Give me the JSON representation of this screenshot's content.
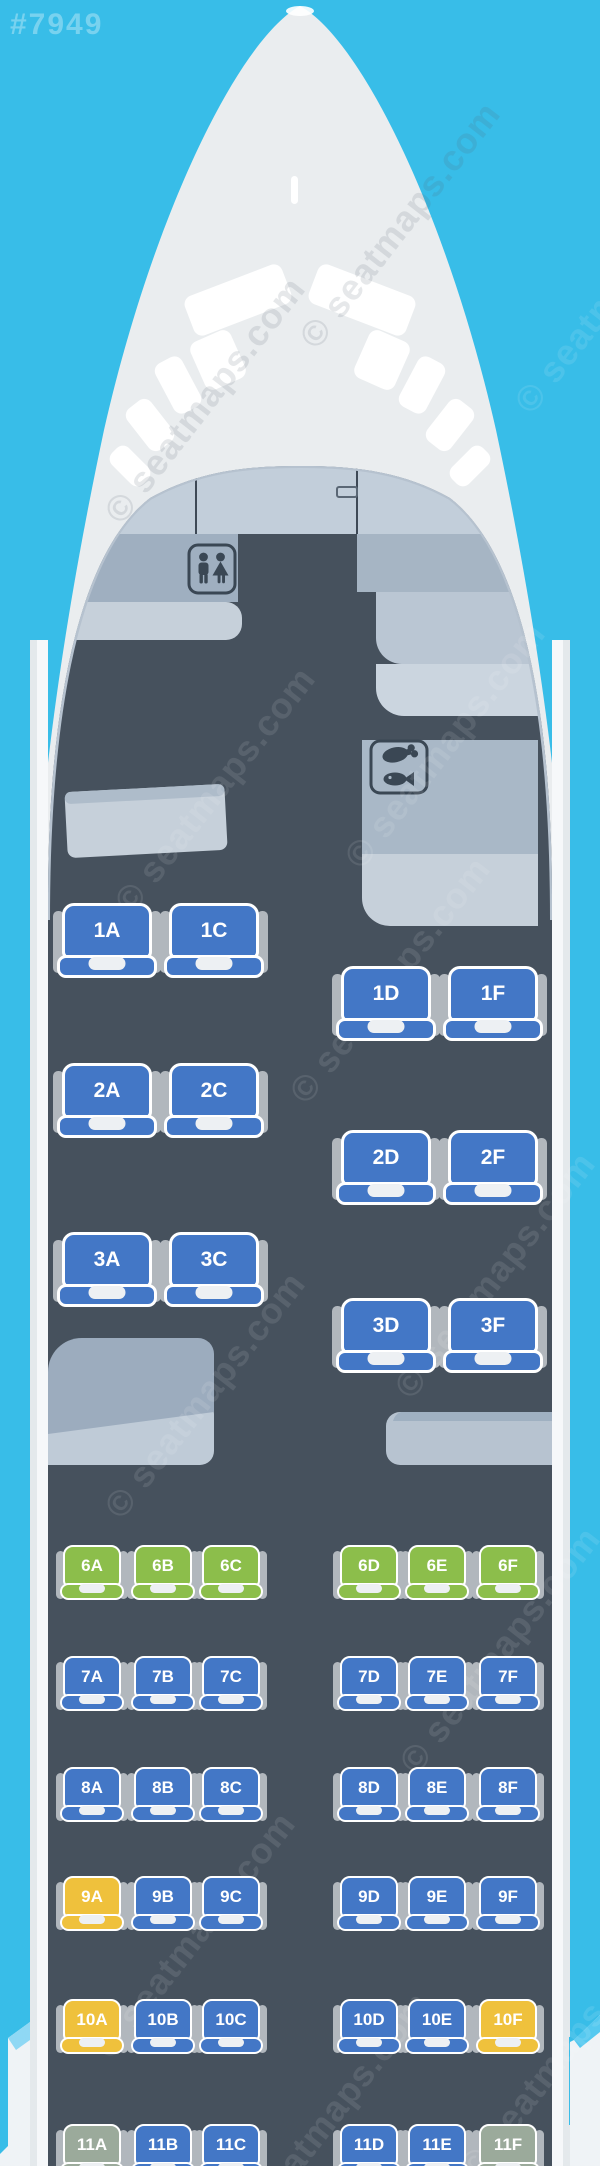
{
  "map_id": "#7949",
  "watermark_text": "© seatmaps.com",
  "colors": {
    "background": "#38BDE8",
    "fuselage": "#EAEDEF",
    "cabin_floor": "#46515D",
    "seat_blue": "#4377C6",
    "seat_green": "#8CBE4B",
    "seat_yellow": "#EFC13C",
    "seat_sage": "#9BAA9B"
  },
  "icons": {
    "front_monument": "lavatory",
    "right_galley": "meal-service"
  },
  "cabin": {
    "rows": [
      {
        "row": "1",
        "section": "business",
        "seats": [
          {
            "id": "1A",
            "color": "seat_blue"
          },
          {
            "id": "1C",
            "color": "seat_blue"
          },
          {
            "id": "1D",
            "color": "seat_blue"
          },
          {
            "id": "1F",
            "color": "seat_blue"
          }
        ]
      },
      {
        "row": "2",
        "section": "business",
        "seats": [
          {
            "id": "2A",
            "color": "seat_blue"
          },
          {
            "id": "2C",
            "color": "seat_blue"
          },
          {
            "id": "2D",
            "color": "seat_blue"
          },
          {
            "id": "2F",
            "color": "seat_blue"
          }
        ]
      },
      {
        "row": "3",
        "section": "business",
        "seats": [
          {
            "id": "3A",
            "color": "seat_blue"
          },
          {
            "id": "3C",
            "color": "seat_blue"
          },
          {
            "id": "3D",
            "color": "seat_blue"
          },
          {
            "id": "3F",
            "color": "seat_blue"
          }
        ]
      },
      {
        "row": "6",
        "section": "economy",
        "seats": [
          {
            "id": "6A",
            "color": "seat_green"
          },
          {
            "id": "6B",
            "color": "seat_green"
          },
          {
            "id": "6C",
            "color": "seat_green"
          },
          {
            "id": "6D",
            "color": "seat_green"
          },
          {
            "id": "6E",
            "color": "seat_green"
          },
          {
            "id": "6F",
            "color": "seat_green"
          }
        ]
      },
      {
        "row": "7",
        "section": "economy",
        "seats": [
          {
            "id": "7A",
            "color": "seat_blue"
          },
          {
            "id": "7B",
            "color": "seat_blue"
          },
          {
            "id": "7C",
            "color": "seat_blue"
          },
          {
            "id": "7D",
            "color": "seat_blue"
          },
          {
            "id": "7E",
            "color": "seat_blue"
          },
          {
            "id": "7F",
            "color": "seat_blue"
          }
        ]
      },
      {
        "row": "8",
        "section": "economy",
        "seats": [
          {
            "id": "8A",
            "color": "seat_blue"
          },
          {
            "id": "8B",
            "color": "seat_blue"
          },
          {
            "id": "8C",
            "color": "seat_blue"
          },
          {
            "id": "8D",
            "color": "seat_blue"
          },
          {
            "id": "8E",
            "color": "seat_blue"
          },
          {
            "id": "8F",
            "color": "seat_blue"
          }
        ]
      },
      {
        "row": "9",
        "section": "economy",
        "seats": [
          {
            "id": "9A",
            "color": "seat_yellow"
          },
          {
            "id": "9B",
            "color": "seat_blue"
          },
          {
            "id": "9C",
            "color": "seat_blue"
          },
          {
            "id": "9D",
            "color": "seat_blue"
          },
          {
            "id": "9E",
            "color": "seat_blue"
          },
          {
            "id": "9F",
            "color": "seat_blue"
          }
        ]
      },
      {
        "row": "10",
        "section": "economy",
        "seats": [
          {
            "id": "10A",
            "color": "seat_yellow"
          },
          {
            "id": "10B",
            "color": "seat_blue"
          },
          {
            "id": "10C",
            "color": "seat_blue"
          },
          {
            "id": "10D",
            "color": "seat_blue"
          },
          {
            "id": "10E",
            "color": "seat_blue"
          },
          {
            "id": "10F",
            "color": "seat_yellow"
          }
        ]
      },
      {
        "row": "11",
        "section": "economy",
        "seats": [
          {
            "id": "11A",
            "color": "seat_sage"
          },
          {
            "id": "11B",
            "color": "seat_blue"
          },
          {
            "id": "11C",
            "color": "seat_blue"
          },
          {
            "id": "11D",
            "color": "seat_blue"
          },
          {
            "id": "11E",
            "color": "seat_blue"
          },
          {
            "id": "11F",
            "color": "seat_sage"
          }
        ]
      }
    ]
  }
}
